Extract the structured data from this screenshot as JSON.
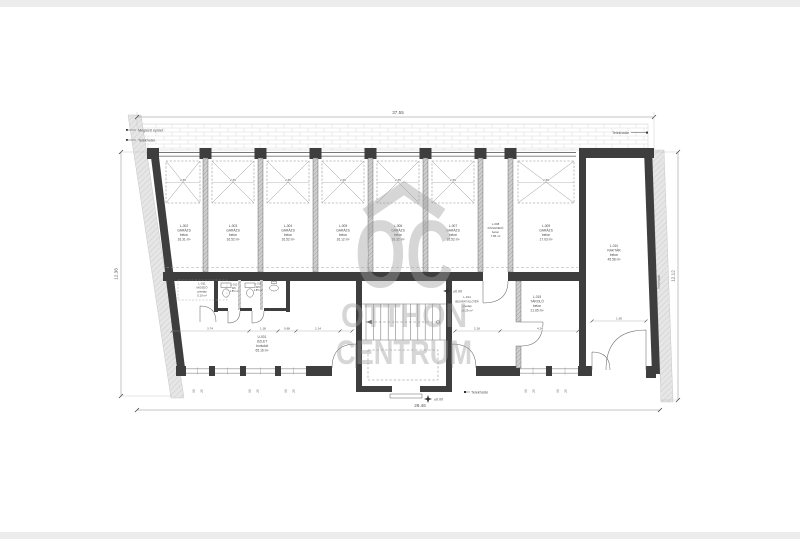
{
  "annotations": {
    "dim_top": "37.55",
    "dim_bottom": "28.46",
    "dim_left": "12.38",
    "dim_right": "12.12",
    "existing_building": "Meglévő épület",
    "property_line": "Telekhatár",
    "level_zero": "±0.00",
    "bay_width": "2.65",
    "door_width": "1.90",
    "shop_dim_1": "3.74",
    "shop_dim_2": "1.38",
    "shop_dim_3": "0.88",
    "shop_dim_4": "2.14",
    "entry_dim_1": "2.18",
    "entry_dim_2": "4.24",
    "window_mark_a": "90",
    "window_mark_b": "25"
  },
  "rooms": [
    {
      "id": "L-002",
      "name": "GARÁZS",
      "finish": "beton",
      "area": "16.31 m²"
    },
    {
      "id": "L-003",
      "name": "GARÁZS",
      "finish": "beton",
      "area": "16.52 m²"
    },
    {
      "id": "L-004",
      "name": "GARÁZS",
      "finish": "beton",
      "area": "16.52 m²"
    },
    {
      "id": "L-005",
      "name": "GARÁZS",
      "finish": "beton",
      "area": "16.12 m²"
    },
    {
      "id": "L-006",
      "name": "GARÁZS",
      "finish": "beton",
      "area": "16.32 m²"
    },
    {
      "id": "L-007",
      "name": "GARÁZS",
      "finish": "beton",
      "area": "16.52 m²"
    },
    {
      "id": "L-008",
      "name": "KÖZLEKEDŐ",
      "finish": "beton",
      "area": "7.86 m²"
    },
    {
      "id": "L-009",
      "name": "GARÁZS",
      "finish": "beton",
      "area": "17.03 m²"
    },
    {
      "id": "L-010",
      "name": "RAKTÁR",
      "finish": "beton",
      "area": "45.58 m²"
    },
    {
      "id": "U-001",
      "name": "ÜZLET",
      "finish": "burkolat",
      "area": "65.16 m²"
    },
    {
      "id": "L-011",
      "name": "MOSDÓ",
      "finish": "greslap",
      "area": "5.10 m²"
    },
    {
      "id": "L-012",
      "name": "WC",
      "area": "1.85 m²"
    },
    {
      "id": "L-013",
      "name": "WC",
      "area": "1.85 m²"
    },
    {
      "id": "L-014",
      "name": "BEJÁRATI ELŐTÉR",
      "finish": "greslap",
      "area": "16.29 m²"
    },
    {
      "id": "L-015",
      "name": "TÁROLÓ",
      "finish": "beton",
      "area": "21.65 m²"
    }
  ],
  "watermark": {
    "monogram": "OC",
    "word1": "OTTHON",
    "word2": "CENTRUM"
  }
}
